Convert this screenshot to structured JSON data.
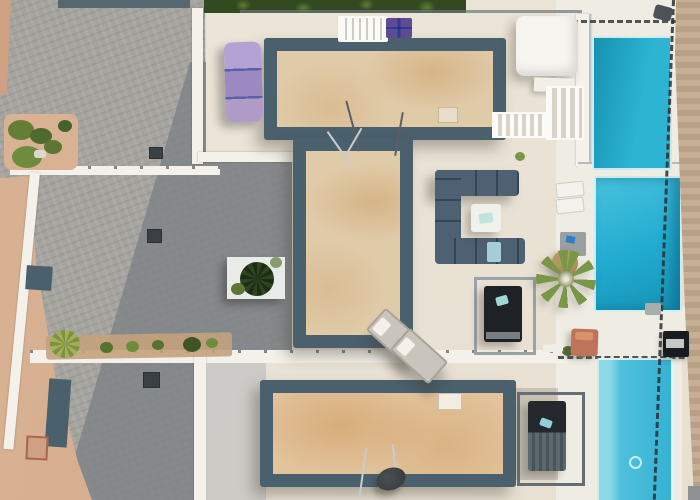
{
  "scene": {
    "description": "Aerial drone view of a modern villa complex with three beige rooftop terraces framed in dark slate, cream sun decks, three turquoise private swimming pools along the right side, grey stone paving and sandy ground on the left, outdoor lounge furniture, purple sun mattresses, palm trees and planters",
    "view": "top-down aerial photo",
    "elements": [
      "rooftop-terrace",
      "swimming-pool",
      "stone-pavement",
      "sand-ground",
      "outdoor-sofa",
      "sun-lounger",
      "daybed",
      "palm-tree",
      "planter",
      "pergola-canopy",
      "railing",
      "glass-fence",
      "barbecue-grill",
      "satellite-dish",
      "hedge"
    ]
  },
  "colors": {
    "deck": "#ece5d8",
    "deckWarm": "#e7dfd0",
    "poolDeck": "#efece4",
    "white": "#f4f1ea",
    "pavement": "#a5a49f",
    "pavementShadow": "#7f8286",
    "sand": "#cda181",
    "sandLight": "#d9b294",
    "wallTan": "#c2a98d",
    "slate": "#4a606d",
    "slateDark": "#3e5360",
    "terrace": "#e0cba9",
    "terrace3": "#e2c39c",
    "pool1Dark": "#1791b2",
    "pool1": "#2cb4d2",
    "pool2": "#21abd0",
    "pool2Light": "#49c2de",
    "pool3": "#35b2d4",
    "pool3Light": "#8ad8e8",
    "hedge": "#33491f",
    "hedgeLight": "#5e7c34",
    "purple1": "#b5a2d4",
    "purple2": "#9d89c2",
    "purpleStripe": "#5b5fa8",
    "sofa": "#4e6173",
    "tealTray": "#bfe4dc",
    "blueSeat": "#a4cdd9",
    "terracotta": "#bf7459",
    "palmGreen": "#7a9647",
    "palmDark": "#54702f",
    "straw": "#d9b97f",
    "frameGray": "#99a3a8",
    "fence": "#2b3034",
    "black": "#1e2227"
  }
}
